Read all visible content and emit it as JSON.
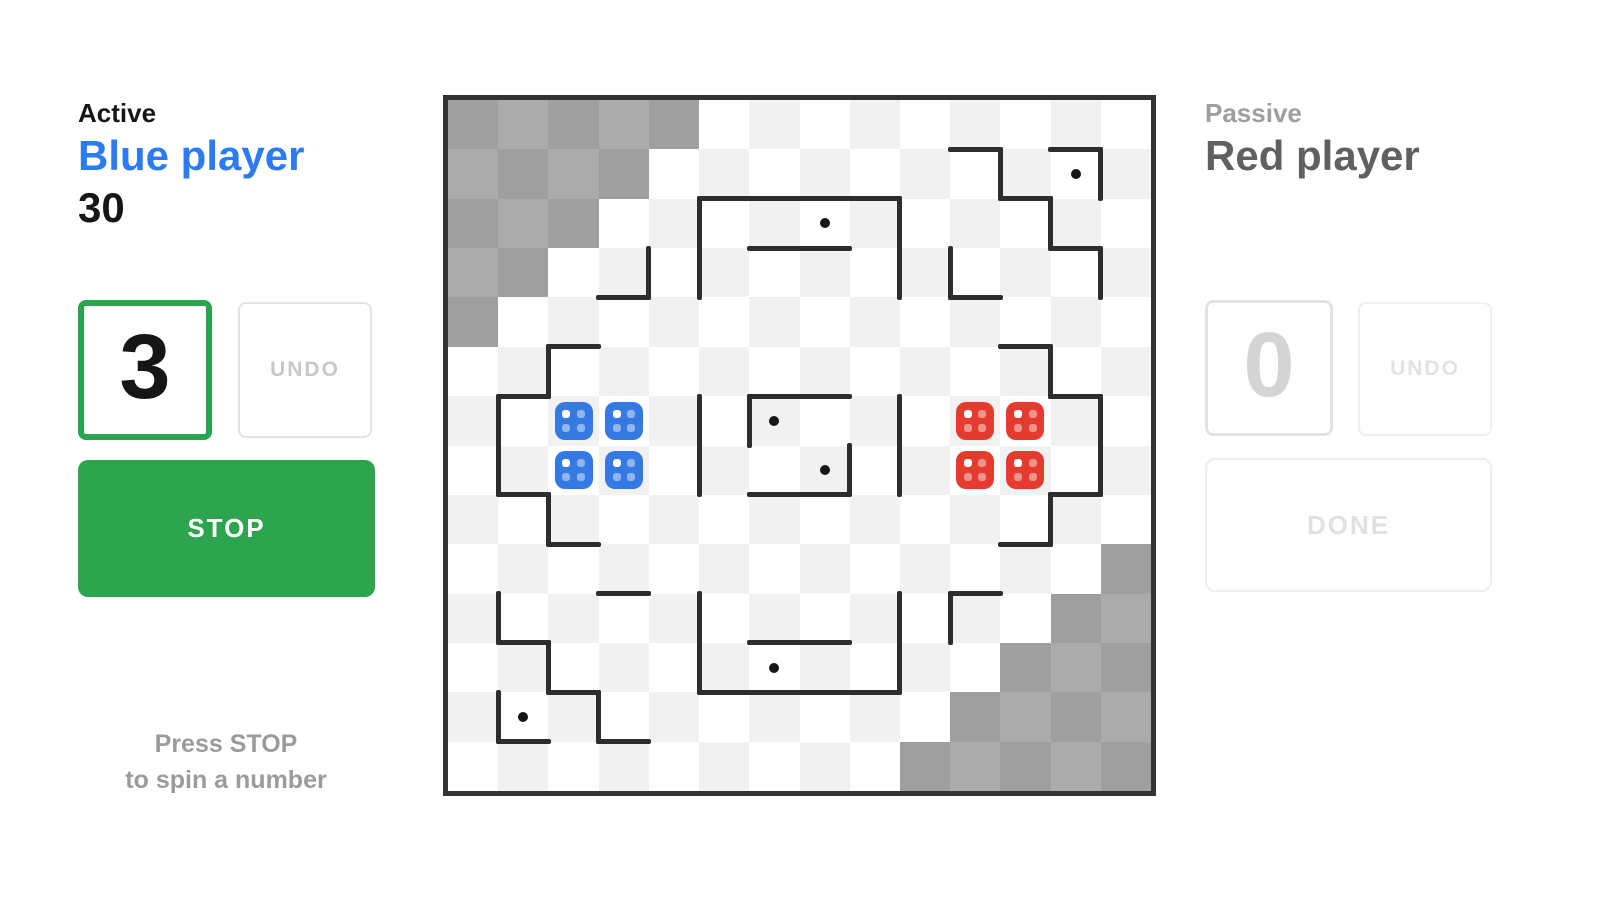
{
  "left_panel": {
    "status_label": "Active",
    "player_name": "Blue player",
    "score": "30",
    "spin_number": "3",
    "undo_label": "UNDO",
    "stop_label": "STOP",
    "hint_line1": "Press STOP",
    "hint_line2": "to spin a number"
  },
  "right_panel": {
    "status_label": "Passive",
    "player_name": "Red player",
    "spin_number": "0",
    "undo_label": "UNDO",
    "done_label": "DONE"
  },
  "colors": {
    "accent_green": "#2da44e",
    "active_number_border": "#2aa44f",
    "player_blue": "#2d7bf2",
    "blue_dice": "#3579e3",
    "red_dice": "#e53a2e",
    "wall": "#2d2d2d",
    "checker_light_even": "#f1f1f1",
    "checker_light_odd": "#ffffff",
    "checker_dark_even": "#9f9f9f",
    "checker_dark_odd": "#ababab"
  },
  "board": {
    "cols": 14,
    "rows": 14,
    "dark_cells": [
      [
        0,
        0
      ],
      [
        1,
        0
      ],
      [
        2,
        0
      ],
      [
        3,
        0
      ],
      [
        4,
        0
      ],
      [
        0,
        1
      ],
      [
        1,
        1
      ],
      [
        2,
        1
      ],
      [
        3,
        1
      ],
      [
        0,
        2
      ],
      [
        1,
        2
      ],
      [
        2,
        2
      ],
      [
        0,
        3
      ],
      [
        1,
        3
      ],
      [
        0,
        4
      ],
      [
        13,
        9
      ],
      [
        12,
        10
      ],
      [
        13,
        10
      ],
      [
        11,
        11
      ],
      [
        12,
        11
      ],
      [
        13,
        11
      ],
      [
        10,
        12
      ],
      [
        11,
        12
      ],
      [
        12,
        12
      ],
      [
        13,
        12
      ],
      [
        9,
        13
      ],
      [
        10,
        13
      ],
      [
        11,
        13
      ],
      [
        12,
        13
      ],
      [
        13,
        13
      ]
    ],
    "h_walls": [
      {
        "c": 10,
        "r": 1,
        "len": 1
      },
      {
        "c": 12,
        "r": 1,
        "len": 1
      },
      {
        "c": 5,
        "r": 2,
        "len": 4
      },
      {
        "c": 11,
        "r": 2,
        "len": 1
      },
      {
        "c": 6,
        "r": 3,
        "len": 2
      },
      {
        "c": 12,
        "r": 3,
        "len": 1
      },
      {
        "c": 3,
        "r": 4,
        "len": 1
      },
      {
        "c": 10,
        "r": 4,
        "len": 1
      },
      {
        "c": 2,
        "r": 5,
        "len": 1
      },
      {
        "c": 11,
        "r": 5,
        "len": 1
      },
      {
        "c": 1,
        "r": 6,
        "len": 1
      },
      {
        "c": 6,
        "r": 6,
        "len": 2
      },
      {
        "c": 12,
        "r": 6,
        "len": 1
      },
      {
        "c": 1,
        "r": 8,
        "len": 1
      },
      {
        "c": 6,
        "r": 8,
        "len": 2
      },
      {
        "c": 12,
        "r": 8,
        "len": 1
      },
      {
        "c": 2,
        "r": 9,
        "len": 1
      },
      {
        "c": 11,
        "r": 9,
        "len": 1
      },
      {
        "c": 3,
        "r": 10,
        "len": 1
      },
      {
        "c": 10,
        "r": 10,
        "len": 1
      },
      {
        "c": 1,
        "r": 11,
        "len": 1
      },
      {
        "c": 6,
        "r": 11,
        "len": 2
      },
      {
        "c": 2,
        "r": 12,
        "len": 1
      },
      {
        "c": 5,
        "r": 12,
        "len": 4
      },
      {
        "c": 1,
        "r": 13,
        "len": 1
      },
      {
        "c": 3,
        "r": 13,
        "len": 1
      }
    ],
    "v_walls": [
      {
        "c": 11,
        "r": 1,
        "len": 1
      },
      {
        "c": 13,
        "r": 1,
        "len": 1
      },
      {
        "c": 5,
        "r": 2,
        "len": 2
      },
      {
        "c": 9,
        "r": 2,
        "len": 2
      },
      {
        "c": 12,
        "r": 2,
        "len": 1
      },
      {
        "c": 4,
        "r": 3,
        "len": 1
      },
      {
        "c": 10,
        "r": 3,
        "len": 1
      },
      {
        "c": 13,
        "r": 3,
        "len": 1
      },
      {
        "c": 2,
        "r": 5,
        "len": 1
      },
      {
        "c": 12,
        "r": 5,
        "len": 1
      },
      {
        "c": 1,
        "r": 6,
        "len": 2
      },
      {
        "c": 5,
        "r": 6,
        "len": 2
      },
      {
        "c": 6,
        "r": 6,
        "len": 1
      },
      {
        "c": 9,
        "r": 6,
        "len": 2
      },
      {
        "c": 13,
        "r": 6,
        "len": 2
      },
      {
        "c": 8,
        "r": 7,
        "len": 1
      },
      {
        "c": 2,
        "r": 8,
        "len": 1
      },
      {
        "c": 12,
        "r": 8,
        "len": 1
      },
      {
        "c": 1,
        "r": 10,
        "len": 1
      },
      {
        "c": 5,
        "r": 10,
        "len": 2
      },
      {
        "c": 9,
        "r": 10,
        "len": 2
      },
      {
        "c": 10,
        "r": 10,
        "len": 1
      },
      {
        "c": 2,
        "r": 11,
        "len": 1
      },
      {
        "c": 1,
        "r": 12,
        "len": 1
      },
      {
        "c": 3,
        "r": 12,
        "len": 1
      }
    ],
    "dots": [
      [
        12,
        1
      ],
      [
        7,
        2
      ],
      [
        6,
        6
      ],
      [
        7,
        7
      ],
      [
        6,
        11
      ],
      [
        1,
        12
      ]
    ],
    "dice": [
      {
        "player": "blue",
        "color": "#3579e3",
        "cells": [
          [
            2,
            6
          ],
          [
            3,
            6
          ],
          [
            2,
            7
          ],
          [
            3,
            7
          ]
        ],
        "pips": 4
      },
      {
        "player": "red",
        "color": "#e53a2e",
        "cells": [
          [
            10,
            6
          ],
          [
            11,
            6
          ],
          [
            10,
            7
          ],
          [
            11,
            7
          ]
        ],
        "pips": 4
      }
    ]
  }
}
